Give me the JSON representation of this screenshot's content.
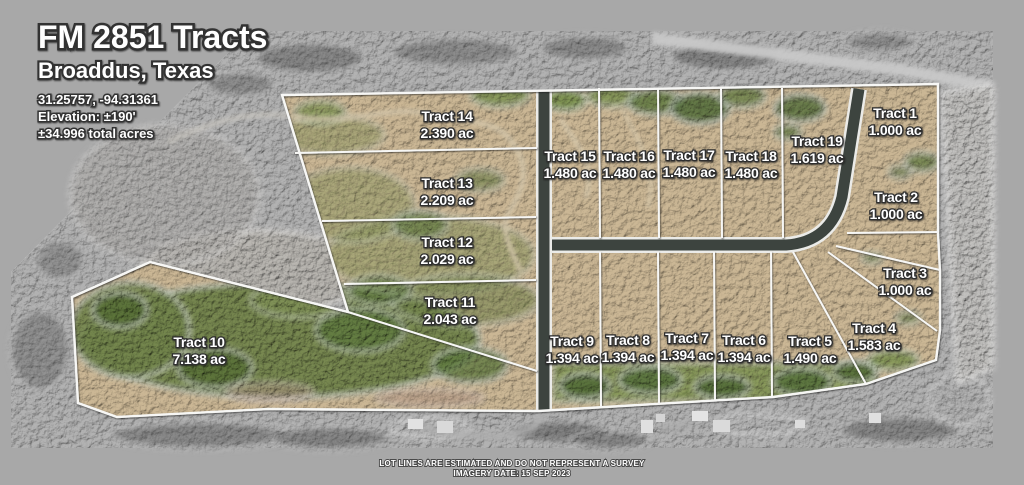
{
  "header": {
    "title": "FM 2851 Tracts",
    "subtitle": "Broaddus, Texas",
    "coordinates": "31.25757, -94.31361",
    "elevation": "Elevation: ±190'",
    "total_acres": "±34.996 total acres"
  },
  "tracts": [
    {
      "name": "Tract 1",
      "acres": "1.000 ac"
    },
    {
      "name": "Tract 2",
      "acres": "1.000 ac"
    },
    {
      "name": "Tract 3",
      "acres": "1.000 ac"
    },
    {
      "name": "Tract 4",
      "acres": "1.583 ac"
    },
    {
      "name": "Tract 5",
      "acres": "1.490 ac"
    },
    {
      "name": "Tract 6",
      "acres": "1.394 ac"
    },
    {
      "name": "Tract 7",
      "acres": "1.394 ac"
    },
    {
      "name": "Tract 8",
      "acres": "1.394 ac"
    },
    {
      "name": "Tract 9",
      "acres": "1.394 ac"
    },
    {
      "name": "Tract 10",
      "acres": "7.138 ac"
    },
    {
      "name": "Tract 11",
      "acres": "2.043 ac"
    },
    {
      "name": "Tract 12",
      "acres": "2.029 ac"
    },
    {
      "name": "Tract 13",
      "acres": "2.209 ac"
    },
    {
      "name": "Tract 14",
      "acres": "2.390 ac"
    },
    {
      "name": "Tract 15",
      "acres": "1.480 ac"
    },
    {
      "name": "Tract 16",
      "acres": "1.480 ac"
    },
    {
      "name": "Tract 17",
      "acres": "1.480 ac"
    },
    {
      "name": "Tract 18",
      "acres": "1.480 ac"
    },
    {
      "name": "Tract 19",
      "acres": "1.619 ac"
    }
  ],
  "footer": {
    "disclaimer": "LOT LINES ARE ESTIMATED AND DO NOT REPRESENT A SURVEY",
    "imagery_date": "IMAGERY DATE: 15 SEP 2023"
  },
  "colors": {
    "frame": "#a8a8a8",
    "photo_gray": "#b2b2b2",
    "land_tan": "#cbb795",
    "vegetation_green": "#74874e",
    "boundary_line": "#f7f7f5",
    "road_dark": "#3d443f",
    "label_text": "#ffffff",
    "label_outline": "#2f2f2f"
  }
}
